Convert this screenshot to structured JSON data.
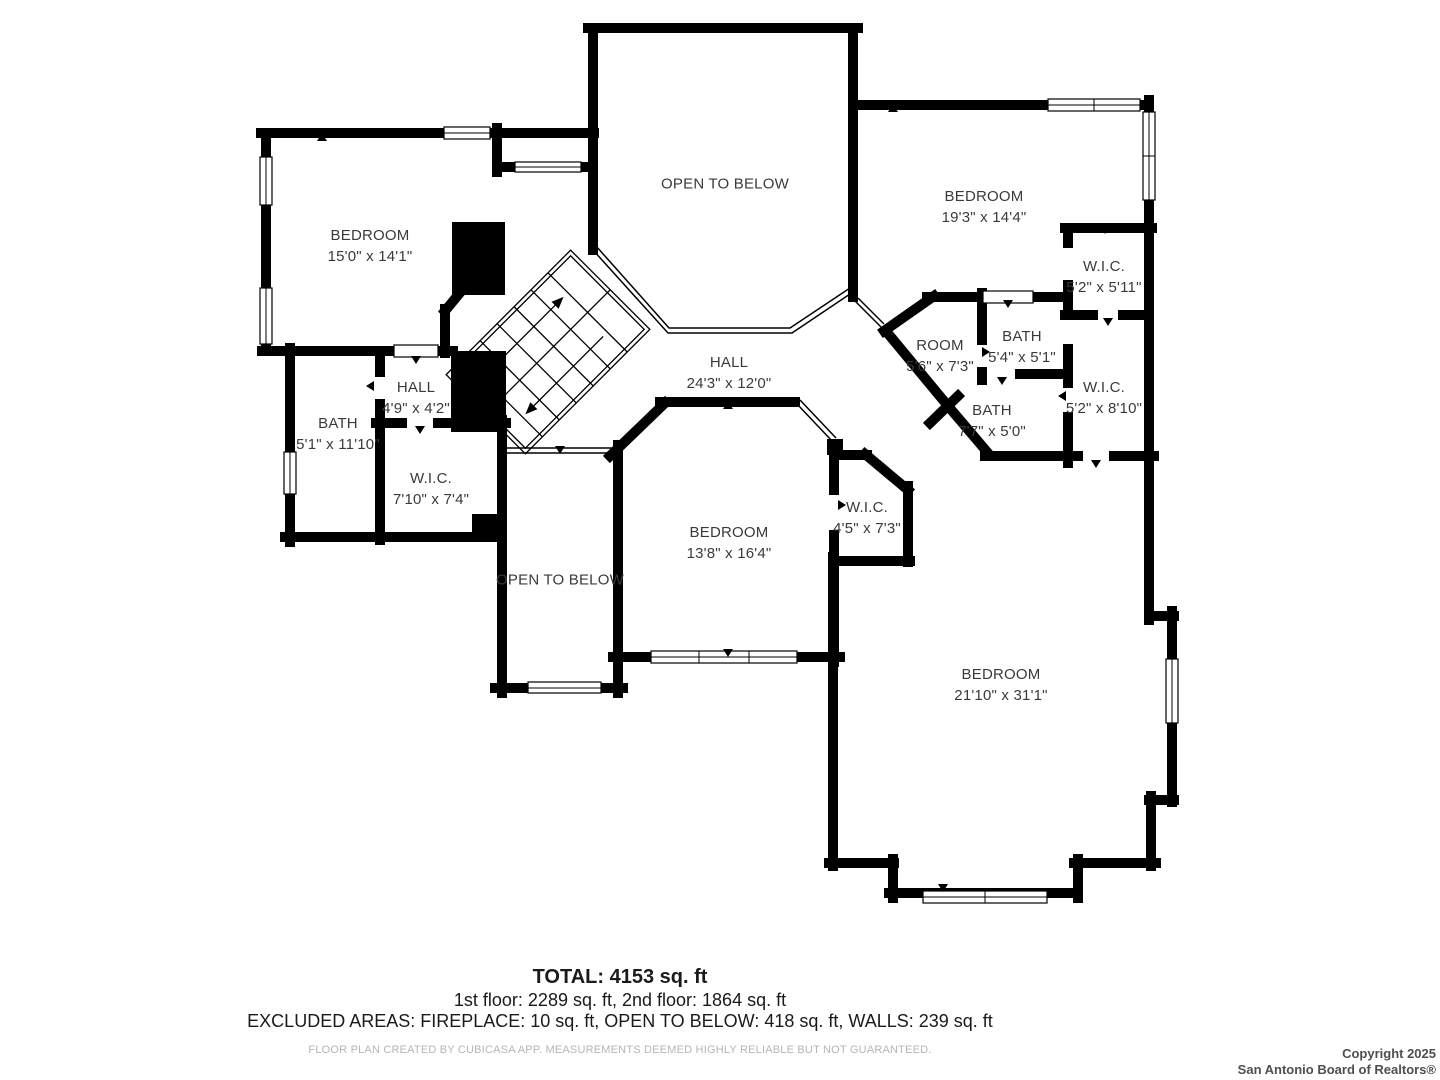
{
  "colors": {
    "walls": "#000000",
    "background": "#ffffff",
    "label_text": "#3a3a3a",
    "footer_text": "#1a1a1a",
    "disclaimer_text": "#b5b5b5",
    "copyright_text": "#4f4f4f"
  },
  "rooms": [
    {
      "name": "BEDROOM",
      "dims": "15'0\" x 14'1\""
    },
    {
      "name": "OPEN TO BELOW",
      "dims": ""
    },
    {
      "name": "BEDROOM",
      "dims": "19'3\" x 14'4\""
    },
    {
      "name": "W.I.C.",
      "dims": "5'2\" x 5'11\""
    },
    {
      "name": "BATH",
      "dims": "5'4\" x 5'1\""
    },
    {
      "name": "ROOM",
      "dims": "5'6\" x 7'3\""
    },
    {
      "name": "W.I.C.",
      "dims": "5'2\" x 8'10\""
    },
    {
      "name": "BATH",
      "dims": "7'7\" x 5'0\""
    },
    {
      "name": "HALL",
      "dims": "24'3\" x 12'0\""
    },
    {
      "name": "HALL",
      "dims": "4'9\" x 4'2\""
    },
    {
      "name": "BATH",
      "dims": "5'1\" x 11'10\""
    },
    {
      "name": "W.I.C.",
      "dims": "7'10\" x 7'4\""
    },
    {
      "name": "OPEN TO BELOW",
      "dims": ""
    },
    {
      "name": "BEDROOM",
      "dims": "13'8\" x 16'4\""
    },
    {
      "name": "W.I.C.",
      "dims": "4'5\" x 7'3\""
    },
    {
      "name": "BEDROOM",
      "dims": "21'10\" x 31'1\""
    }
  ],
  "footer": {
    "total": "TOTAL: 4153 sq. ft",
    "floors": "1st floor: 2289 sq. ft, 2nd floor: 1864 sq. ft",
    "excluded": "EXCLUDED AREAS: FIREPLACE: 10 sq. ft, OPEN TO BELOW: 418 sq. ft, WALLS: 239 sq. ft",
    "disclaimer": "FLOOR PLAN CREATED BY CUBICASA APP. MEASUREMENTS DEEMED HIGHLY RELIABLE BUT NOT GUARANTEED.",
    "copyright_line1": "Copyright 2025",
    "copyright_line2": "San Antonio Board of Realtors®"
  }
}
